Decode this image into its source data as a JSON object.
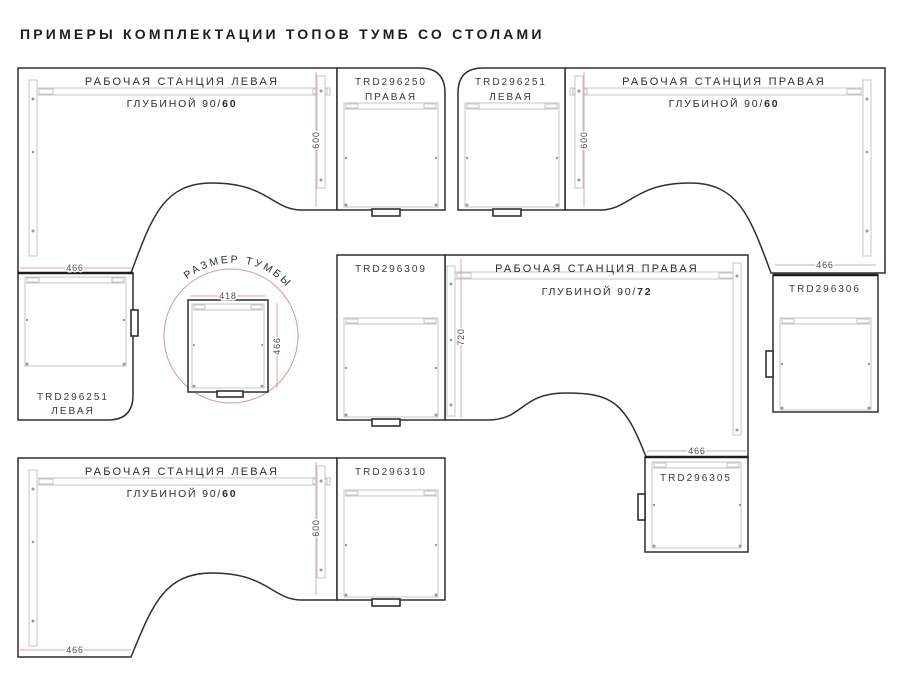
{
  "title": "ПРИМЕРЫ КОМПЛЕКТАЦИИ ТОПОВ ТУМБ СО СТОЛАМИ",
  "colors": {
    "outline": "#2f2f2f",
    "detail_gray": "#c5c5c5",
    "dimension_pink": "#e2a4a6",
    "circle_pink": "#d8989a",
    "text_dark": "#2d2d2d"
  },
  "stations": {
    "top_left": {
      "name": "РАБОЧАЯ СТАНЦИЯ ЛЕВАЯ",
      "depth_prefix": "ГЛУБИНОЙ 90/",
      "depth_value": "60",
      "dim_width": "466",
      "dim_depth": "600",
      "cabinet_right_code": "TRD296250",
      "cabinet_right_side": "ПРАВАЯ",
      "cabinet_bottom_code": "TRD296251",
      "cabinet_bottom_side": "ЛЕВАЯ"
    },
    "top_right": {
      "name": "РАБОЧАЯ СТАНЦИЯ ПРАВАЯ",
      "depth_prefix": "ГЛУБИНОЙ 90/",
      "depth_value": "60",
      "dim_width": "466",
      "dim_depth": "600",
      "cabinet_left_code": "TRD296251",
      "cabinet_left_side": "ЛЕВАЯ",
      "cabinet_bottom_code": "TRD296306"
    },
    "middle_right": {
      "name": "РАБОЧАЯ СТАНЦИЯ ПРАВАЯ",
      "depth_prefix": "ГЛУБИНОЙ 90/",
      "depth_value": "72",
      "dim_width": "466",
      "dim_depth": "720",
      "cabinet_left_code": "TRD296309",
      "cabinet_bottom_code": "TRD296305"
    },
    "bottom_left": {
      "name": "РАБОЧАЯ СТАНЦИЯ ЛЕВАЯ",
      "depth_prefix": "ГЛУБИНОЙ 90/",
      "depth_value": "60",
      "dim_width": "466",
      "dim_depth": "600",
      "cabinet_right_code": "TRD296310"
    }
  },
  "size_detail": {
    "label": "РАЗМЕР ТУМБЫ",
    "dim_width": "418",
    "dim_height": "466"
  }
}
